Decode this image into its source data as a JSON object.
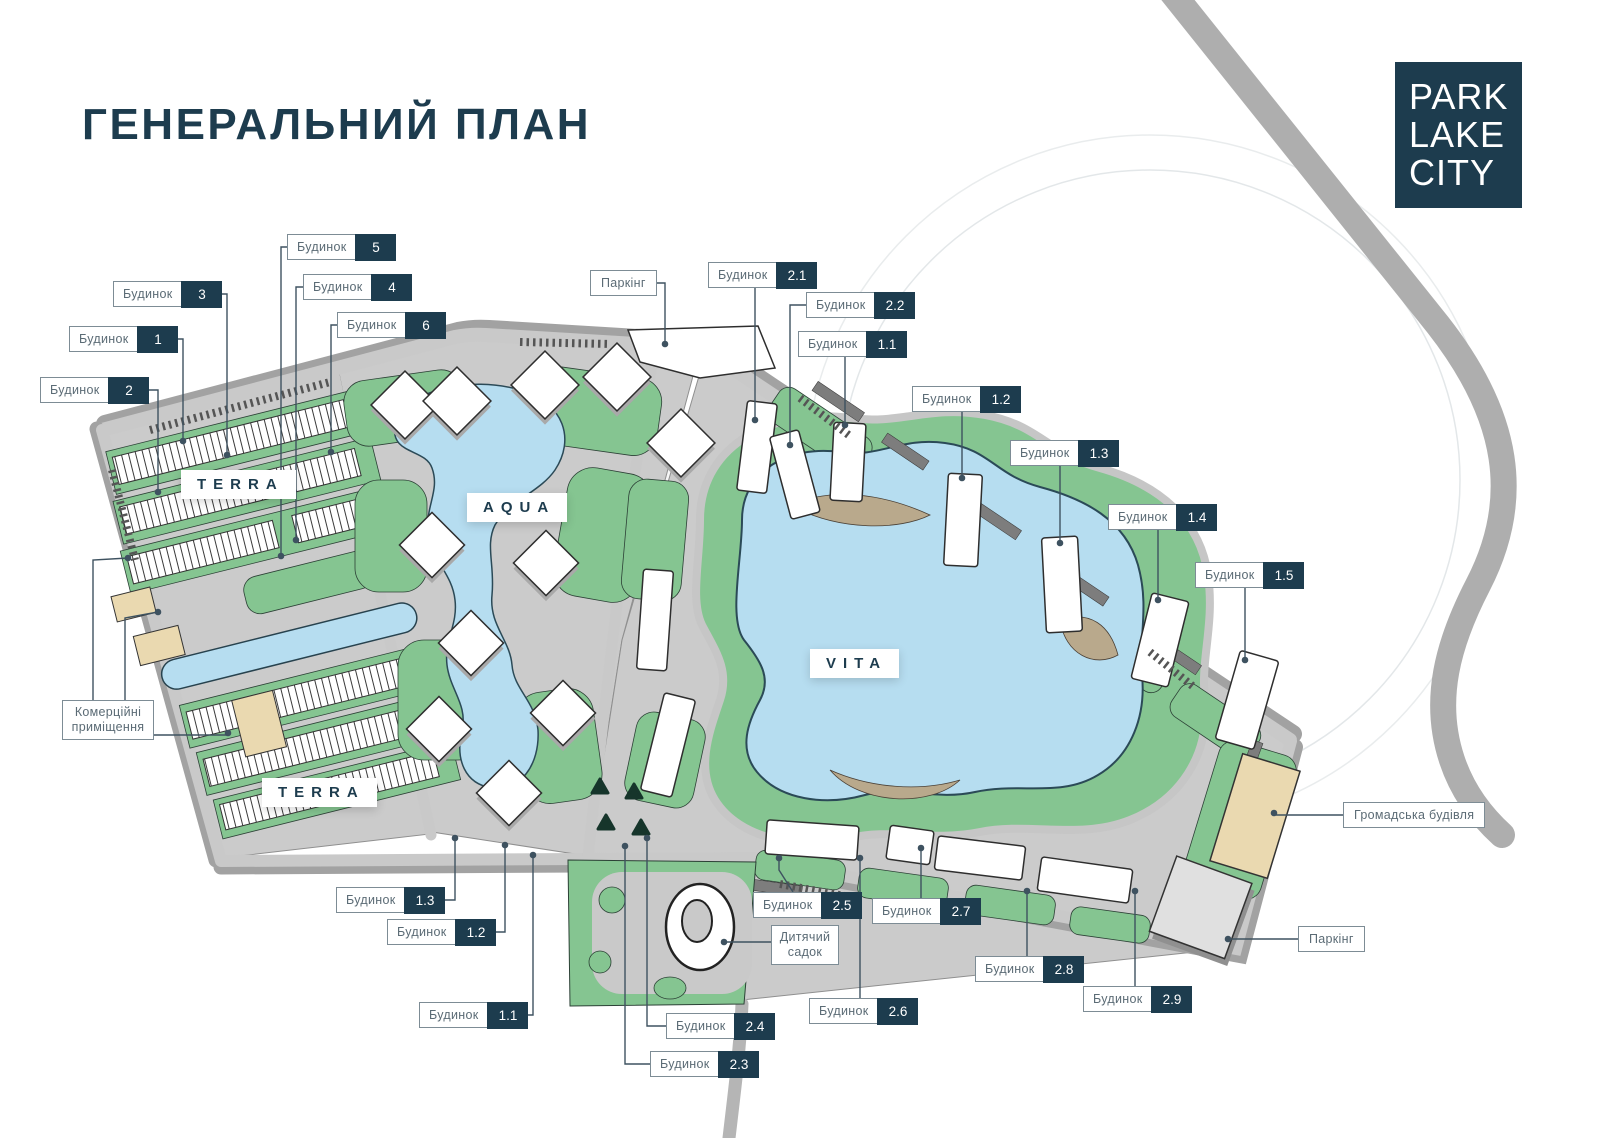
{
  "page": {
    "title": "ГЕНЕРАЛЬНИЙ ПЛАН"
  },
  "brand": {
    "lines": [
      "PARK",
      "LAKE",
      "CITY"
    ]
  },
  "watermark": {
    "big": "EVA",
    "small": "GROUP"
  },
  "districts": [
    {
      "id": "terra-north",
      "label": "TERRA"
    },
    {
      "id": "aqua",
      "label": "AQUA"
    },
    {
      "id": "terra-south",
      "label": "TERRA"
    },
    {
      "id": "vita",
      "label": "VITA"
    }
  ],
  "labels": [
    {
      "name": "Будинок",
      "badge": "5"
    },
    {
      "name": "Будинок",
      "badge": "3"
    },
    {
      "name": "Будинок",
      "badge": "4"
    },
    {
      "name": "Будинок",
      "badge": "1"
    },
    {
      "name": "Будинок",
      "badge": "6"
    },
    {
      "name": "Будинок",
      "badge": "2"
    },
    {
      "name": "Паркінг"
    },
    {
      "name": "Будинок",
      "badge": "2.1"
    },
    {
      "name": "Будинок",
      "badge": "2.2"
    },
    {
      "name": "Будинок",
      "badge": "1.1"
    },
    {
      "name": "Будинок",
      "badge": "1.2"
    },
    {
      "name": "Будинок",
      "badge": "1.3"
    },
    {
      "name": "Будинок",
      "badge": "1.4"
    },
    {
      "name": "Будинок",
      "badge": "1.5"
    },
    {
      "name": "Комерційні приміщення"
    },
    {
      "name": "Будинок",
      "badge": "1.3"
    },
    {
      "name": "Будинок",
      "badge": "1.2"
    },
    {
      "name": "Будинок",
      "badge": "1.1"
    },
    {
      "name": "Будинок",
      "badge": "2.5"
    },
    {
      "name": "Будинок",
      "badge": "2.7"
    },
    {
      "name": "Дитячий садок"
    },
    {
      "name": "Будинок",
      "badge": "2.6"
    },
    {
      "name": "Будинок",
      "badge": "2.4"
    },
    {
      "name": "Будинок",
      "badge": "2.3"
    },
    {
      "name": "Будинок",
      "badge": "2.8"
    },
    {
      "name": "Будинок",
      "badge": "2.9"
    },
    {
      "name": "Громадська будівля"
    },
    {
      "name": "Паркінг"
    }
  ],
  "colors": {
    "navy": "#1d3c4e",
    "green": "#85c591",
    "lake": "#b6ddf0",
    "road": "#c9c9c9",
    "beige": "#ead9b0"
  }
}
